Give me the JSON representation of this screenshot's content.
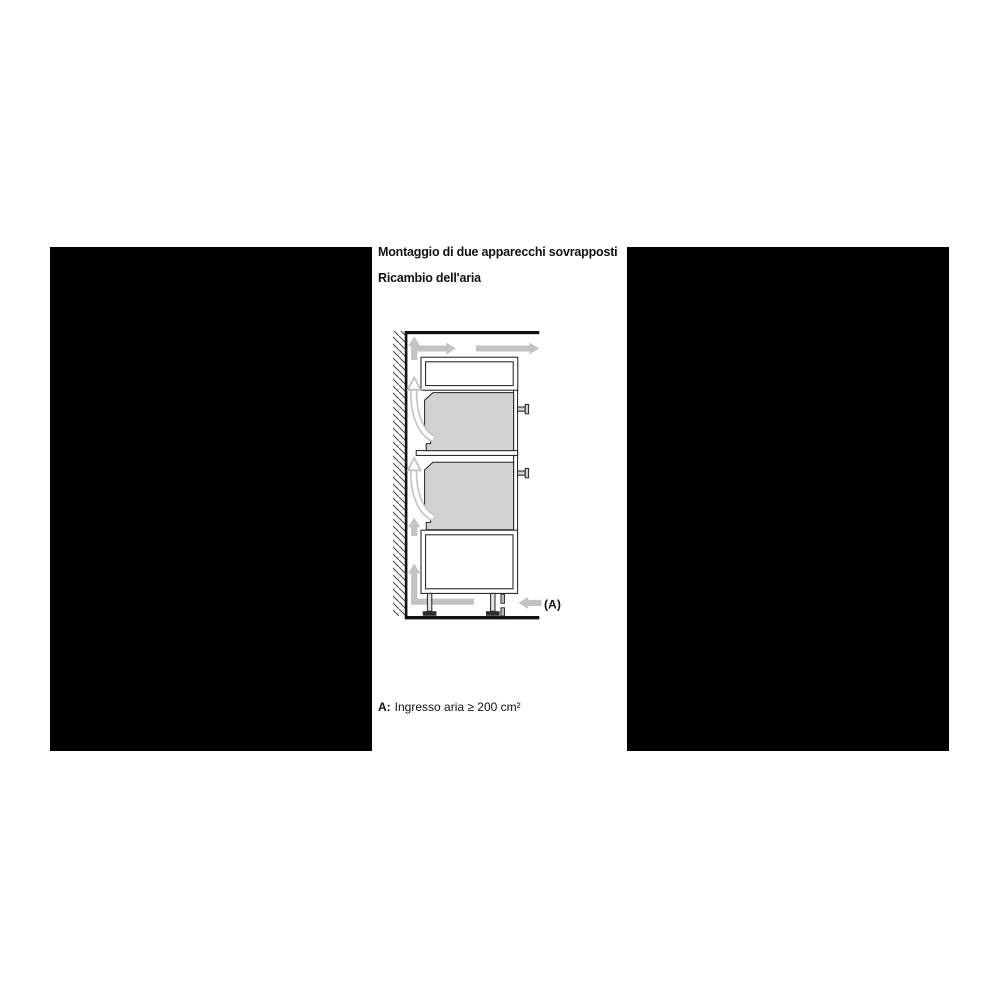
{
  "page": {
    "title": "Montaggio di due apparecchi sovrapposti",
    "subtitle": "Ricambio dell'aria",
    "caption_label": "A:",
    "caption_text": "Ingresso aria ≥ 200 cm²"
  },
  "diagram": {
    "label_a": "(A)",
    "wall": "hatched-wall-left",
    "airflow_arrows": [
      "up-arrow-along-wall-top",
      "right-arrow-over-top-shelf",
      "right-arrow-exit-top-front",
      "curved-up-arrow-behind-upper-oven",
      "curved-up-arrow-behind-lower-oven",
      "up-arrow-behind-base-cabinet",
      "l-arrow-under-cabinet-to-wall",
      "left-arrow-air-inlet-a"
    ],
    "colors": {
      "appliance_fill": "#d2d2d2",
      "arrow_gray": "#c3c3c3",
      "line_black": "#1a1a1a",
      "mask_black": "#000000",
      "background": "#ffffff"
    }
  }
}
